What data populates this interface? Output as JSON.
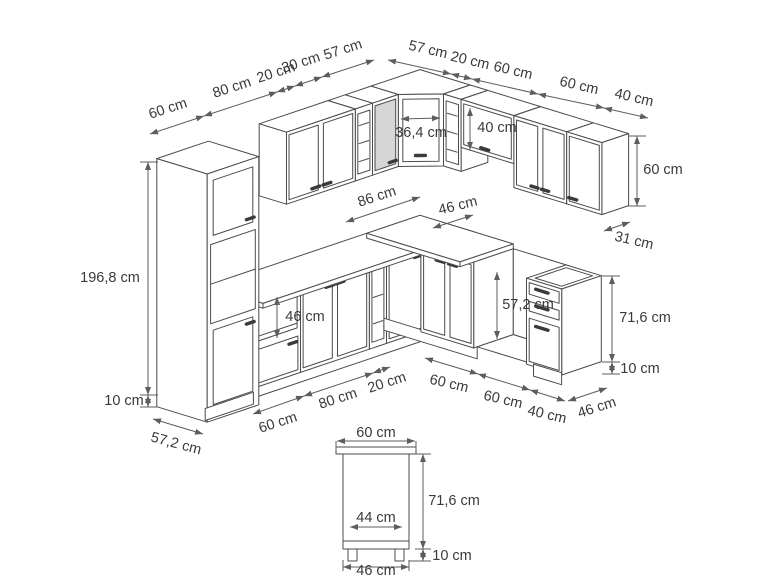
{
  "diagram": {
    "unit": "cm",
    "line_color": "#4b4b4b",
    "dim_color": "#5d5d5d",
    "glass_panel_color": "#d6d6d6",
    "dimension_labels": [
      {
        "id": "top-left-60",
        "text": "60 cm",
        "x": 168,
        "y": 109,
        "rot": -18
      },
      {
        "id": "top-left-80",
        "text": "80 cm",
        "x": 232,
        "y": 88,
        "rot": -18
      },
      {
        "id": "top-left-20",
        "text": "20 cm",
        "x": 276,
        "y": 73,
        "rot": -18
      },
      {
        "id": "top-left-30",
        "text": "30 cm",
        "x": 301,
        "y": 63,
        "rot": -18
      },
      {
        "id": "top-left-57",
        "text": "57 cm",
        "x": 343,
        "y": 50,
        "rot": -18
      },
      {
        "id": "top-right-57",
        "text": "57 cm",
        "x": 428,
        "y": 50,
        "rot": 13
      },
      {
        "id": "top-right-20",
        "text": "20 cm",
        "x": 470,
        "y": 61,
        "rot": 13
      },
      {
        "id": "top-right-60a",
        "text": "60 cm",
        "x": 513,
        "y": 71,
        "rot": 13
      },
      {
        "id": "top-right-60b",
        "text": "60 cm",
        "x": 579,
        "y": 86,
        "rot": 13
      },
      {
        "id": "top-right-40",
        "text": "40 cm",
        "x": 634,
        "y": 98,
        "rot": 13
      },
      {
        "id": "corner-width",
        "text": "36,4 cm",
        "x": 421,
        "y": 133,
        "rot": 0
      },
      {
        "id": "hood-cab-height",
        "text": "40 cm",
        "x": 497,
        "y": 128,
        "rot": 0
      },
      {
        "id": "wall-right-height",
        "text": "60 cm",
        "x": 663,
        "y": 170,
        "rot": 0
      },
      {
        "id": "wall-right-depth",
        "text": "31 cm",
        "x": 634,
        "y": 241,
        "rot": 13
      },
      {
        "id": "corner-base-width",
        "text": "86 cm",
        "x": 377,
        "y": 197,
        "rot": -18
      },
      {
        "id": "base-right-depth",
        "text": "46 cm",
        "x": 458,
        "y": 206,
        "rot": -14
      },
      {
        "id": "oven-niche",
        "text": "46 cm",
        "x": 305,
        "y": 317,
        "rot": 0
      },
      {
        "id": "appliance-niche",
        "text": "57,2 cm",
        "x": 528,
        "y": 305,
        "rot": 0
      },
      {
        "id": "drawer-height",
        "text": "71,6 cm",
        "x": 645,
        "y": 318,
        "rot": 0
      },
      {
        "id": "drawer-plinth",
        "text": "10 cm",
        "x": 640,
        "y": 369,
        "rot": 0
      },
      {
        "id": "tall-height",
        "text": "196,8 cm",
        "x": 110,
        "y": 278,
        "rot": 0
      },
      {
        "id": "tall-plinth",
        "text": "10 cm",
        "x": 124,
        "y": 401,
        "rot": 0
      },
      {
        "id": "tall-depth",
        "text": "57,2 cm",
        "x": 176,
        "y": 444,
        "rot": 15
      },
      {
        "id": "bottom-oven-60",
        "text": "60 cm",
        "x": 278,
        "y": 423,
        "rot": -18
      },
      {
        "id": "bottom-80",
        "text": "80 cm",
        "x": 338,
        "y": 399,
        "rot": -18
      },
      {
        "id": "bottom-20",
        "text": "20 cm",
        "x": 387,
        "y": 383,
        "rot": -18
      },
      {
        "id": "bottom-sink-60",
        "text": "60 cm",
        "x": 449,
        "y": 384,
        "rot": 13
      },
      {
        "id": "bottom-niche-60",
        "text": "60 cm",
        "x": 503,
        "y": 400,
        "rot": 13
      },
      {
        "id": "bottom-drawer-40",
        "text": "40 cm",
        "x": 547,
        "y": 415,
        "rot": 13
      },
      {
        "id": "bottom-depth-46",
        "text": "46 cm",
        "x": 597,
        "y": 408,
        "rot": -18
      },
      {
        "id": "detail-top-60",
        "text": "60 cm",
        "x": 376,
        "y": 433,
        "rot": 0
      },
      {
        "id": "detail-height",
        "text": "71,6 cm",
        "x": 454,
        "y": 501,
        "rot": 0
      },
      {
        "id": "detail-inner-44",
        "text": "44 cm",
        "x": 376,
        "y": 518,
        "rot": 0
      },
      {
        "id": "detail-plinth-10",
        "text": "10 cm",
        "x": 452,
        "y": 556,
        "rot": 0
      },
      {
        "id": "detail-bottom-46",
        "text": "46 cm",
        "x": 376,
        "y": 571,
        "rot": 0
      }
    ]
  }
}
